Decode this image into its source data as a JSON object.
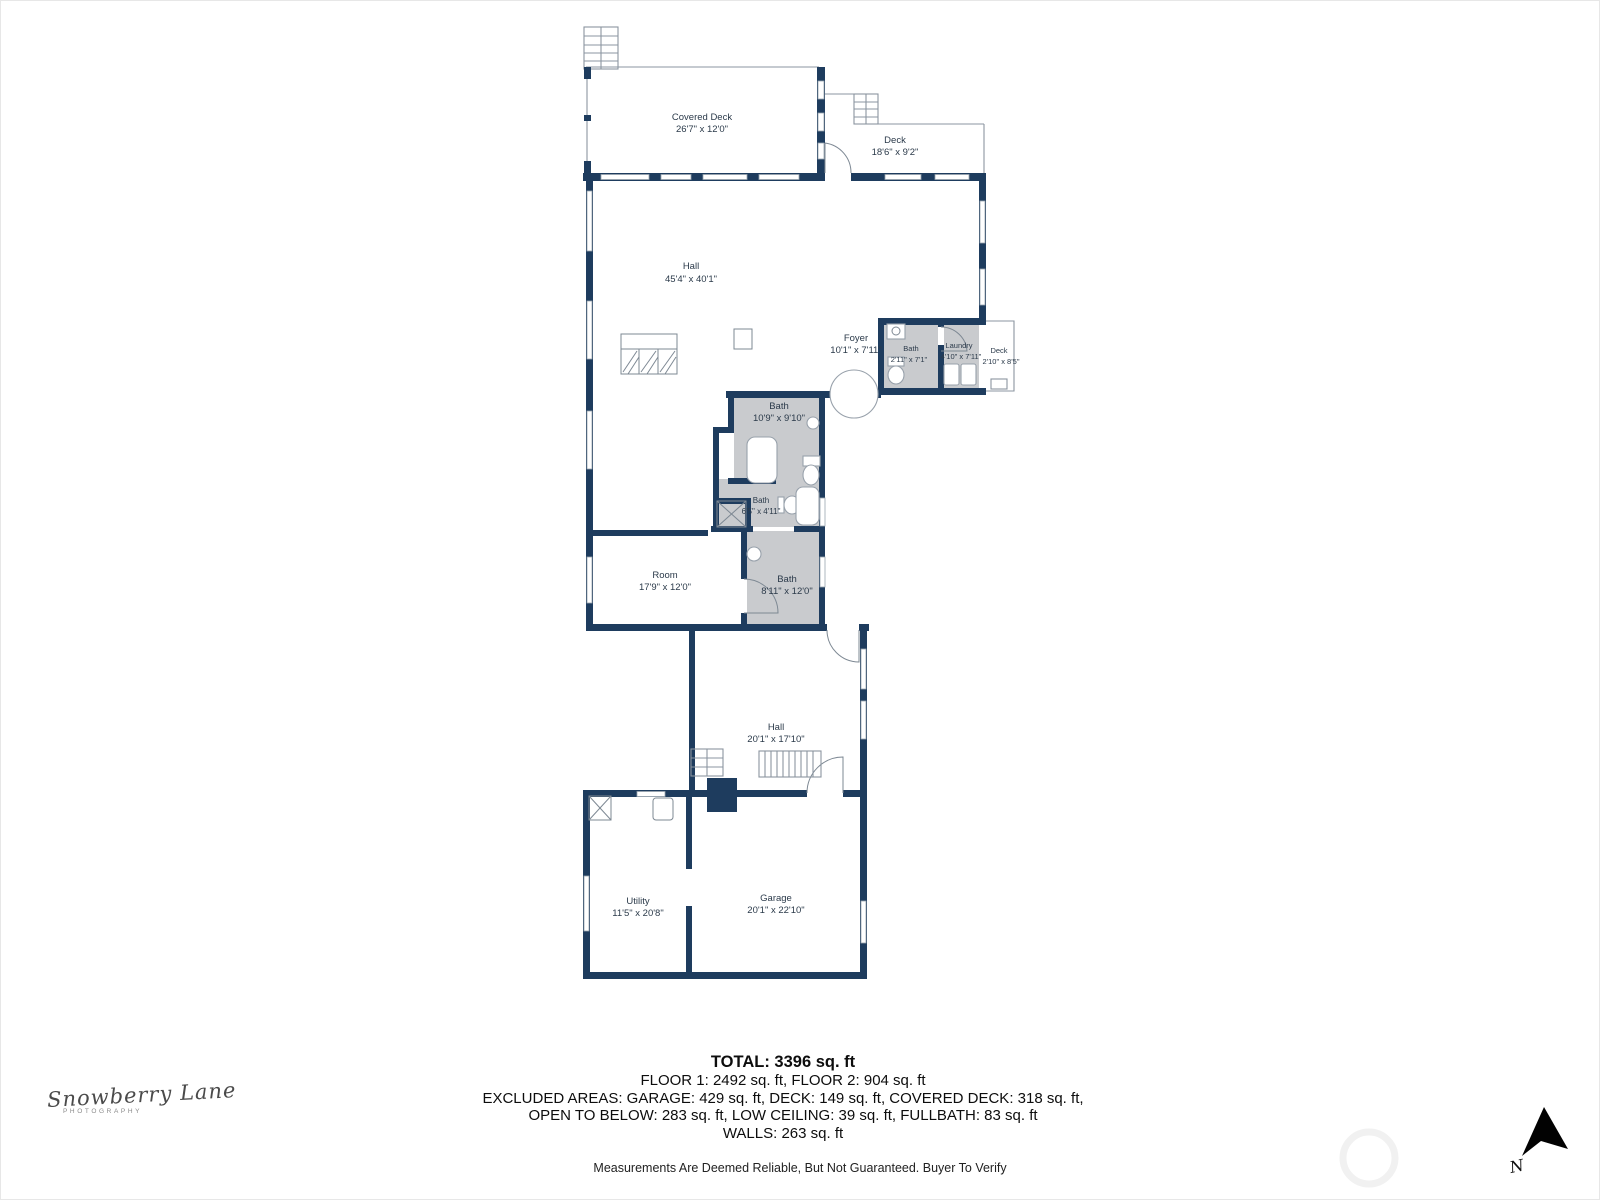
{
  "colors": {
    "wall": "#1e3c5e",
    "room_gray": "#c9cbce",
    "label_text": "#2b3a4a"
  },
  "floorplan": {
    "rooms": [
      {
        "id": "covered-deck",
        "name": "Covered Deck",
        "dims": "26'7\" x 12'0\""
      },
      {
        "id": "deck-upper",
        "name": "Deck",
        "dims": "18'6\" x 9'2\""
      },
      {
        "id": "hall-main",
        "name": "Hall",
        "dims": "45'4\" x 40'1\""
      },
      {
        "id": "foyer",
        "name": "Foyer",
        "dims": "10'1\" x 7'11\""
      },
      {
        "id": "bath-hall",
        "name": "Bath",
        "dims": "2'11\" x 7'1\""
      },
      {
        "id": "laundry",
        "name": "Laundry",
        "dims": "4'10\" x 7'11\""
      },
      {
        "id": "deck-side",
        "name": "Deck",
        "dims": "2'10\" x 8'5\""
      },
      {
        "id": "bath-upper",
        "name": "Bath",
        "dims": "10'9\" x 9'10\""
      },
      {
        "id": "bath-mid",
        "name": "Bath",
        "dims": "6'5\" x 4'11\""
      },
      {
        "id": "room",
        "name": "Room",
        "dims": "17'9\" x 12'0\""
      },
      {
        "id": "bath-lower",
        "name": "Bath",
        "dims": "8'11\" x 12'0\""
      },
      {
        "id": "hall-lower",
        "name": "Hall",
        "dims": "20'1\" x 17'10\""
      },
      {
        "id": "utility",
        "name": "Utility",
        "dims": "11'5\" x 20'8\""
      },
      {
        "id": "garage",
        "name": "Garage",
        "dims": "20'1\" x 22'10\""
      }
    ]
  },
  "summary": {
    "total": "TOTAL: 3396 sq. ft",
    "floors": "FLOOR 1: 2492 sq. ft, FLOOR 2: 904 sq. ft",
    "excluded1": "EXCLUDED AREAS: GARAGE: 429 sq. ft, DECK: 149 sq. ft, COVERED DECK: 318 sq. ft,",
    "excluded2": "OPEN TO BELOW: 283 sq. ft, LOW CEILING: 39 sq. ft, FULLBATH: 83 sq. ft",
    "walls": "WALLS: 263 sq. ft",
    "disclaimer": "Measurements Are Deemed Reliable, But Not Guaranteed. Buyer To Verify"
  },
  "branding": {
    "name": "Snowberry Lane",
    "sub": "PHOTOGRAPHY"
  },
  "compass": {
    "n": "N"
  }
}
